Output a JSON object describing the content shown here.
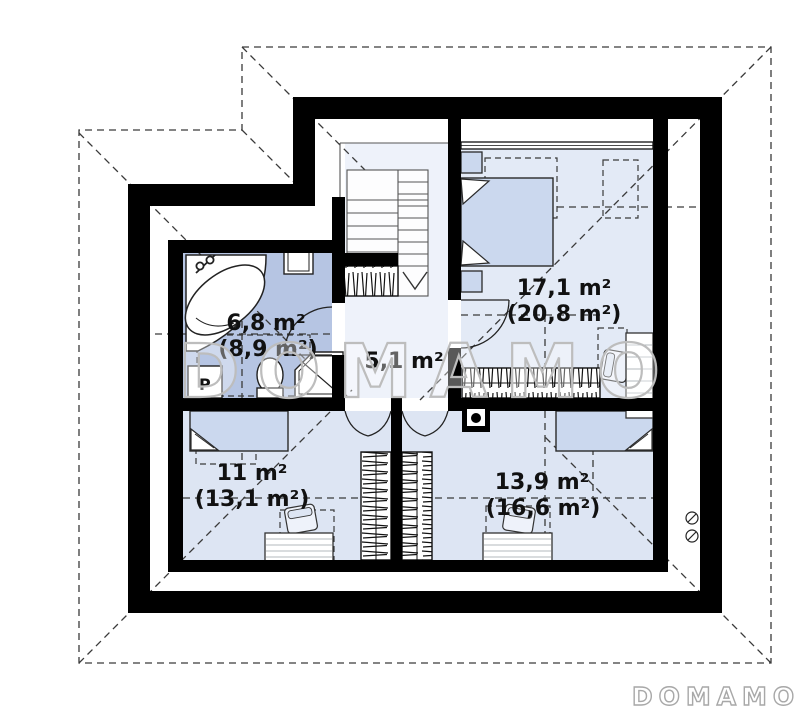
{
  "watermark_text": "DOMAMO",
  "brand_logo_text": "DOMAMO",
  "rooms": [
    {
      "name": "bathroom",
      "area_usable": "6,8 m²",
      "area_floor": "(8,9 m²)"
    },
    {
      "name": "hall",
      "area_usable": "5,1 m²",
      "area_floor": ""
    },
    {
      "name": "bedroom-top-right",
      "area_usable": "17,1 m²",
      "area_floor": "(20,8 m²)"
    },
    {
      "name": "bedroom-bottom-left",
      "area_usable": "11 m²",
      "area_floor": "(13,1 m²)"
    },
    {
      "name": "bedroom-bottom-right",
      "area_usable": "13,9 m²",
      "area_floor": "(16,6 m²)"
    }
  ],
  "labels": {
    "washing_machine": "P"
  },
  "colors": {
    "walls": "#000000",
    "bathroom_floor": "#b6c5e3",
    "bedroom_floor": "#dde5f3",
    "bedroom_floor_light": "#e3eaf6",
    "hall_floor": "#eef2fa",
    "furniture_fill": "#cbd8ee",
    "dashed_line": "#3a3a3a",
    "watermark_outline": "#bdbdbd"
  }
}
